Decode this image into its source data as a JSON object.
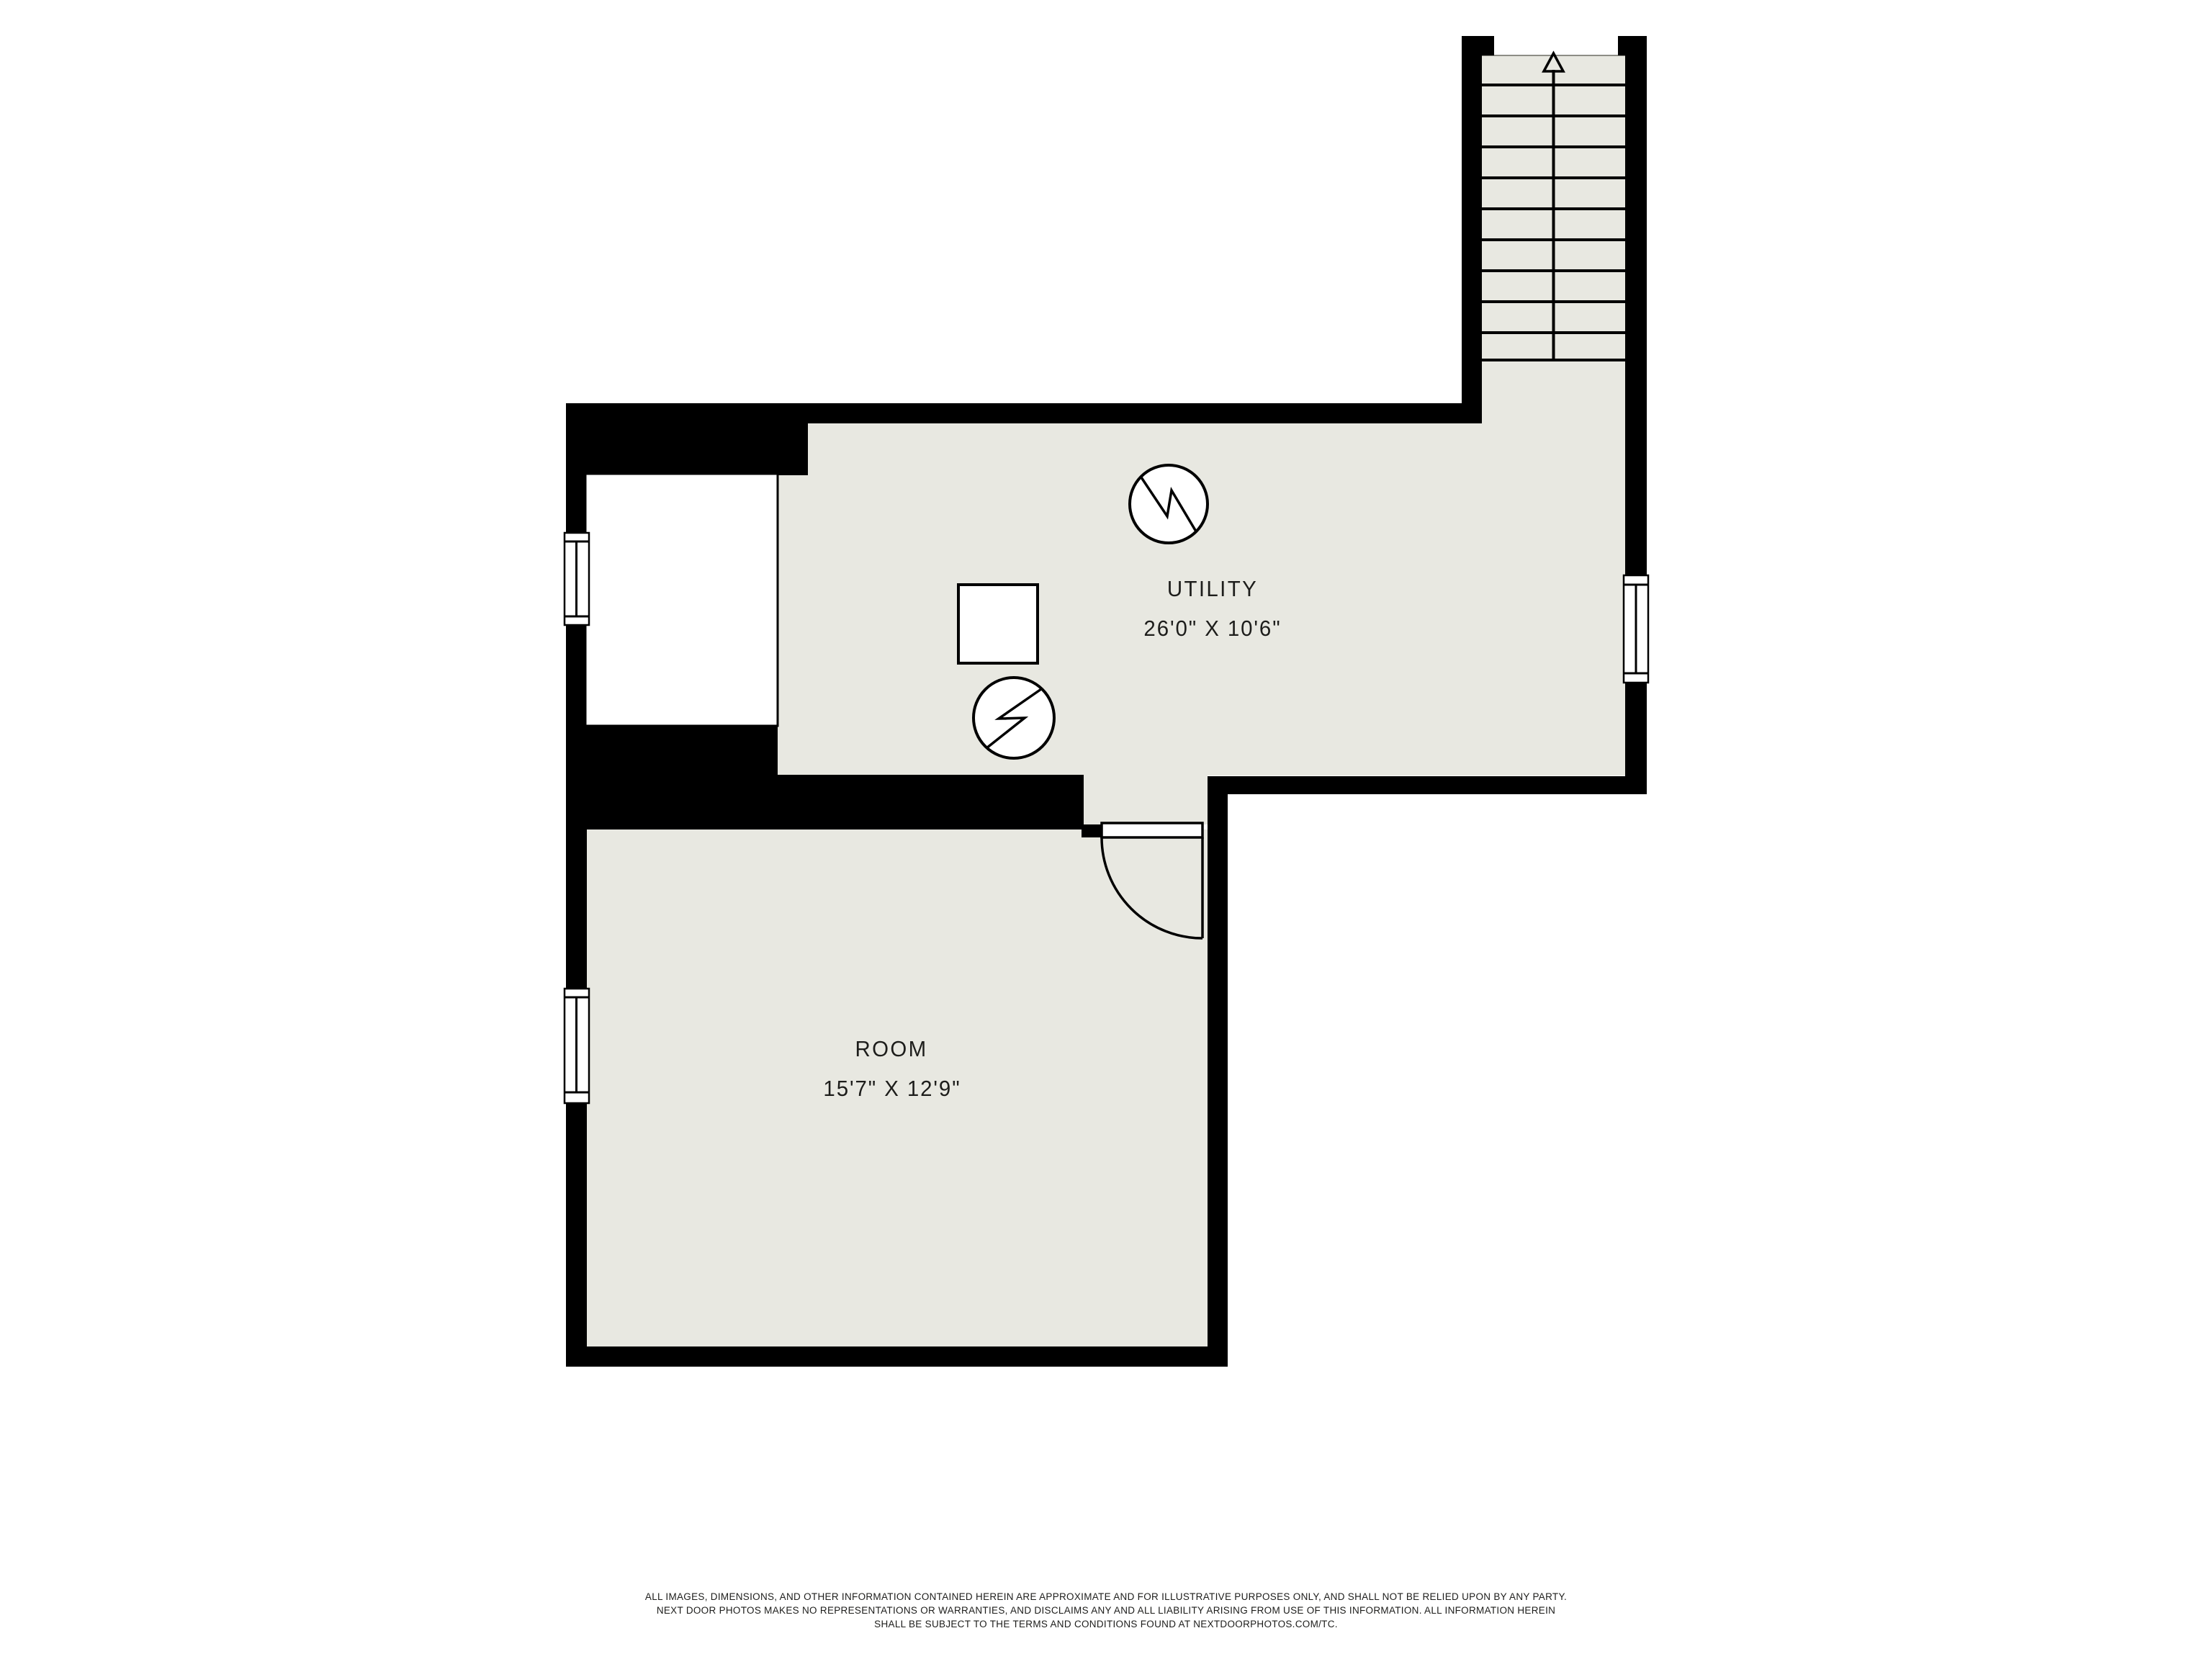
{
  "plan": {
    "rooms": [
      {
        "name": "UTILITY",
        "dimensions": "26'0\" X 10'6\""
      },
      {
        "name": "ROOM",
        "dimensions": "15'7\" X 12'9\""
      }
    ],
    "features": [
      "staircase-up",
      "furnace-symbol",
      "water-heater-symbol",
      "equipment-square",
      "closet-area",
      "door-swing",
      "window-left-utility",
      "window-left-room",
      "window-right-utility"
    ]
  },
  "disclaimer": {
    "lines": [
      "ALL IMAGES, DIMENSIONS, AND OTHER INFORMATION CONTAINED HEREIN ARE APPROXIMATE AND FOR ILLUSTRATIVE PURPOSES ONLY, AND SHALL NOT BE RELIED UPON BY ANY PARTY.",
      "NEXT DOOR PHOTOS MAKES NO REPRESENTATIONS OR WARRANTIES, AND DISCLAIMS ANY AND ALL LIABILITY ARISING FROM USE OF THIS INFORMATION. ALL INFORMATION HEREIN",
      "SHALL BE SUBJECT TO THE TERMS AND CONDITIONS FOUND AT NEXTDOORPHOTOS.COM/TC."
    ]
  },
  "colors": {
    "wall": "#000000",
    "floor": "#e8e8e1",
    "text": "#1d1d1b",
    "background": "#ffffff"
  }
}
